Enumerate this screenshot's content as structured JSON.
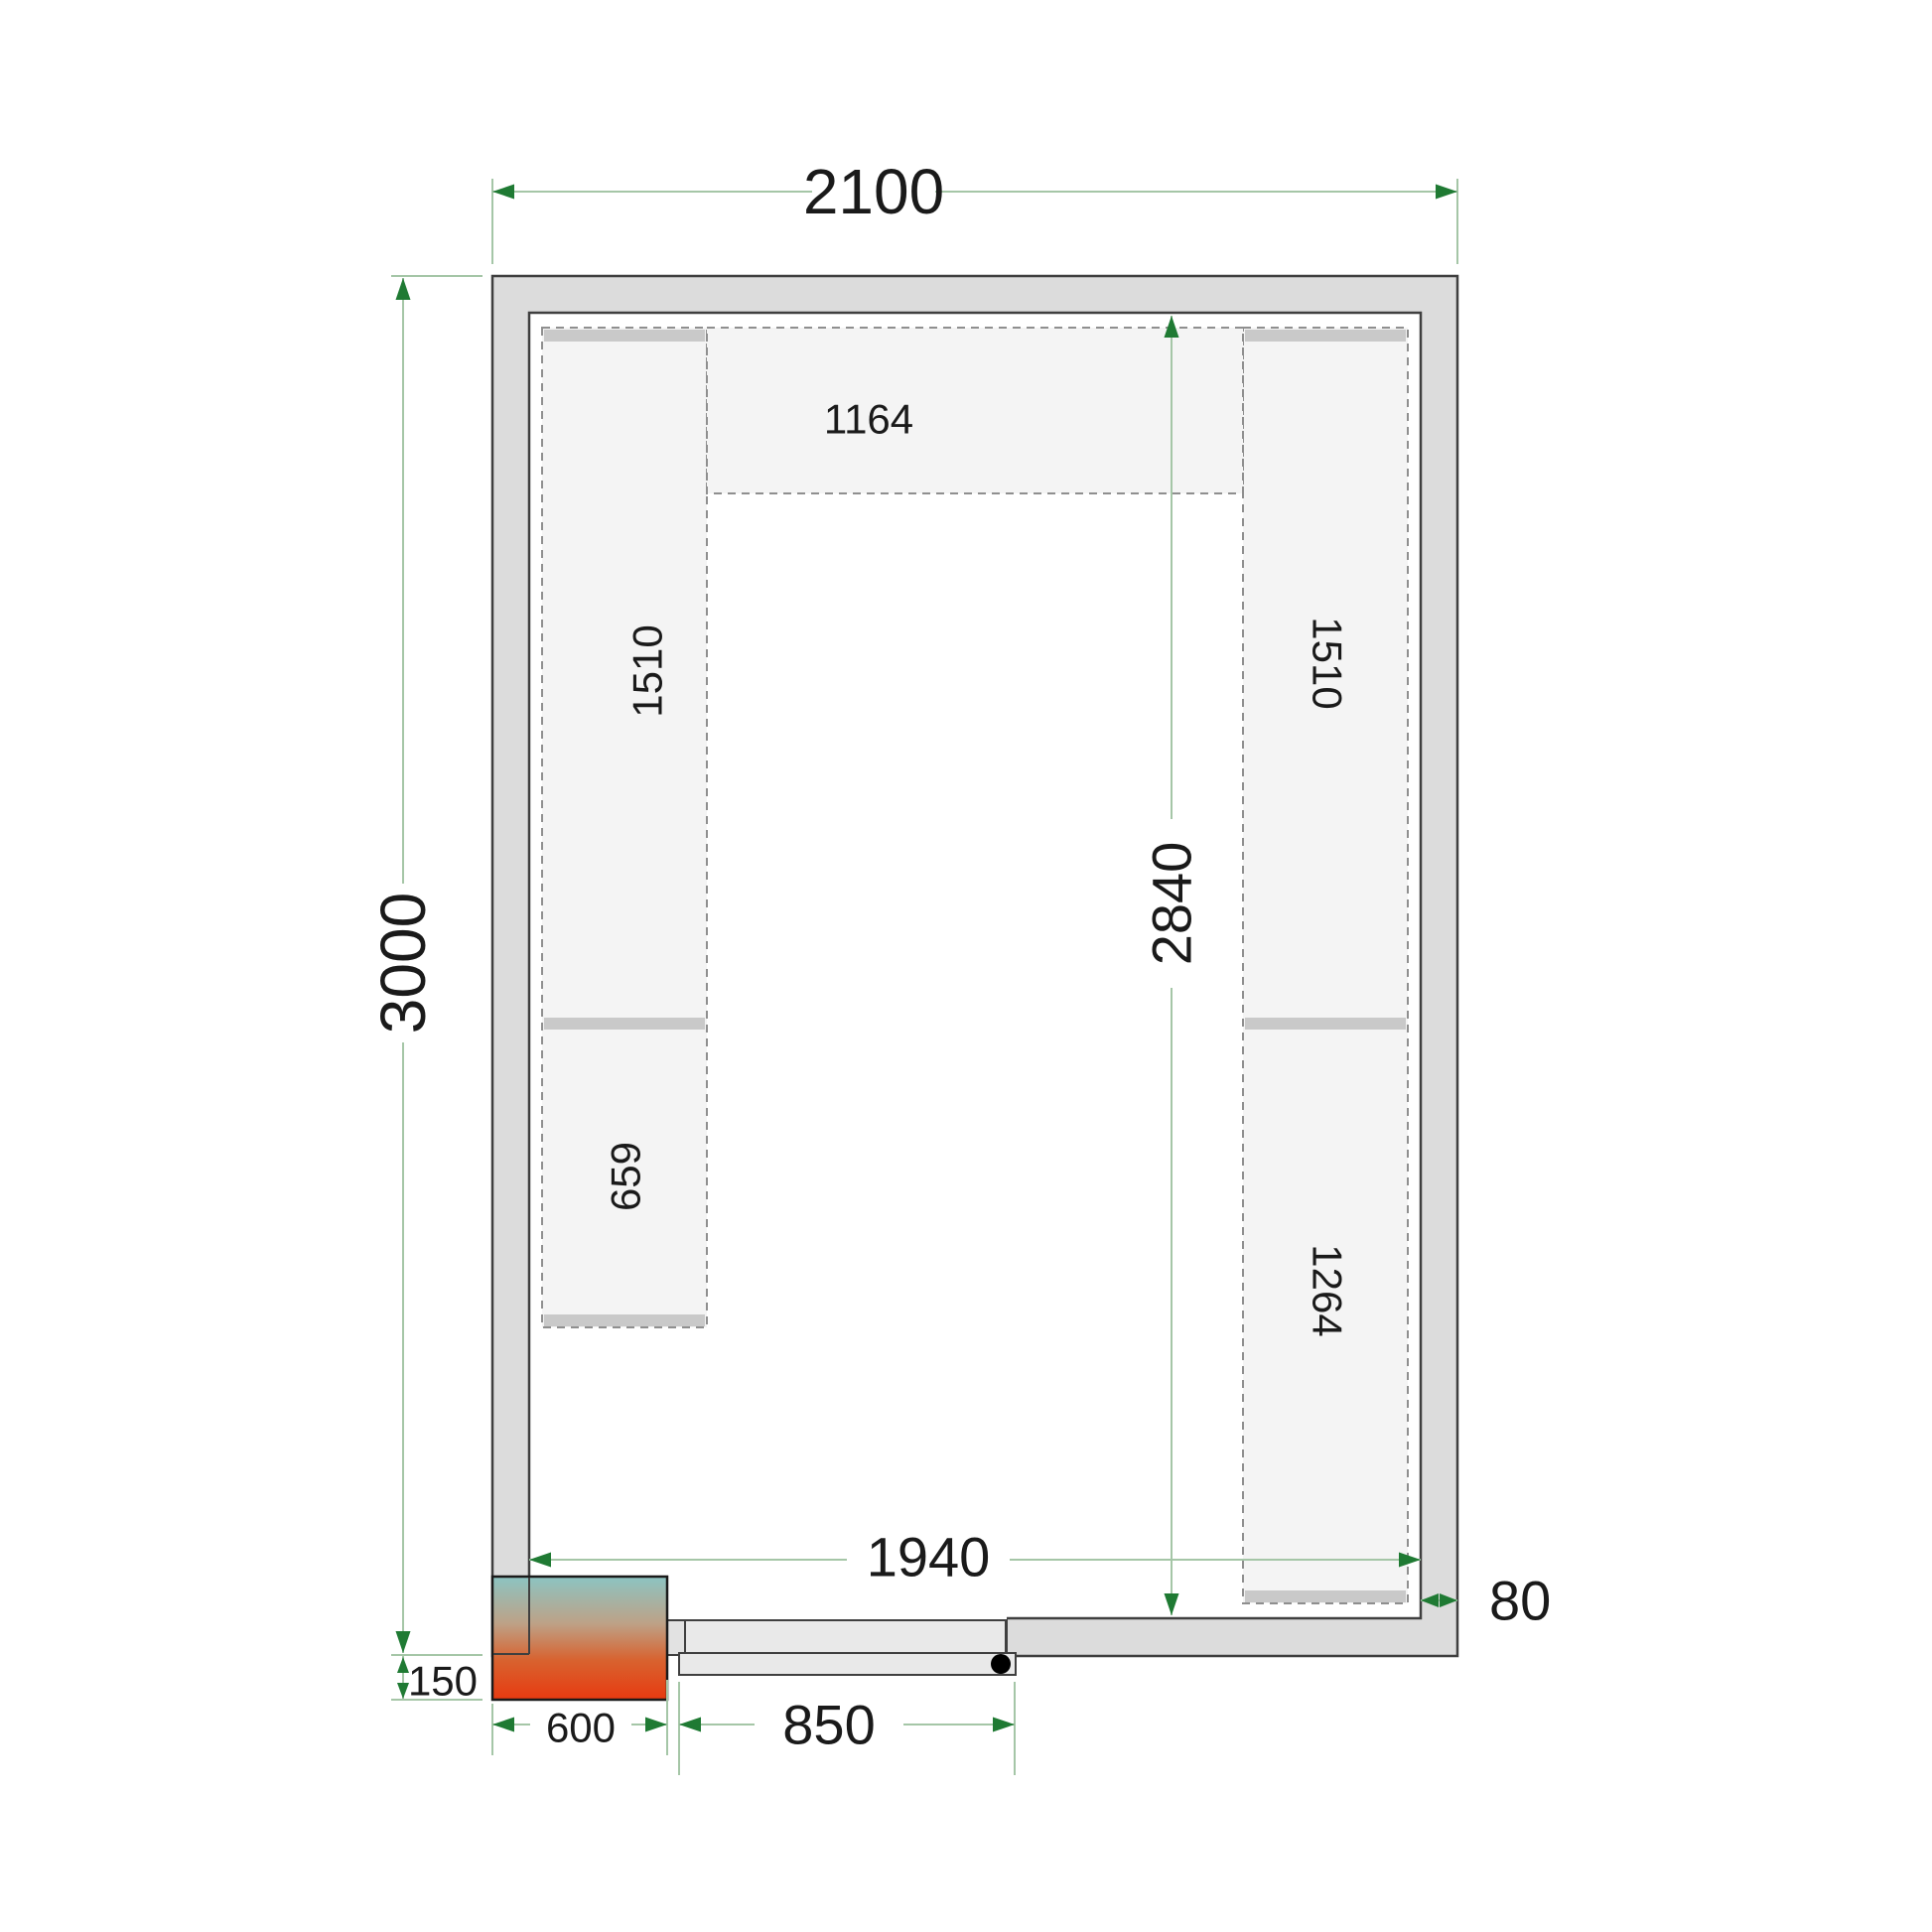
{
  "drawing": {
    "title": "cold-room-floor-plan",
    "dimensions": {
      "outer_width": "2100",
      "outer_height": "3000",
      "inner_height": "2840",
      "inner_width": "1940",
      "door_width": "850",
      "unit_width": "600",
      "unit_offset": "150",
      "wall_thickness": "80"
    },
    "shelves": {
      "top": "1164",
      "left_upper": "1510",
      "left_lower": "659",
      "right_upper": "1510",
      "right_lower": "1264"
    },
    "colors": {
      "wall_fill": "#dcdcdc",
      "outline": "#3f3f3f",
      "shelf_fill": "#f4f4f4",
      "shelf_cap": "#c9c9c9",
      "shelf_dash": "#8f8f8f",
      "dimension_line": "#a5c6a7",
      "dimension_arrow": "#1f7a33",
      "text": "#1a1a1a",
      "unit_gradient_top": "#8cc4c2",
      "unit_gradient_mid": "#bda287",
      "unit_gradient_bottom": "#e73a10",
      "door_fill": "#e9e9e9"
    }
  }
}
